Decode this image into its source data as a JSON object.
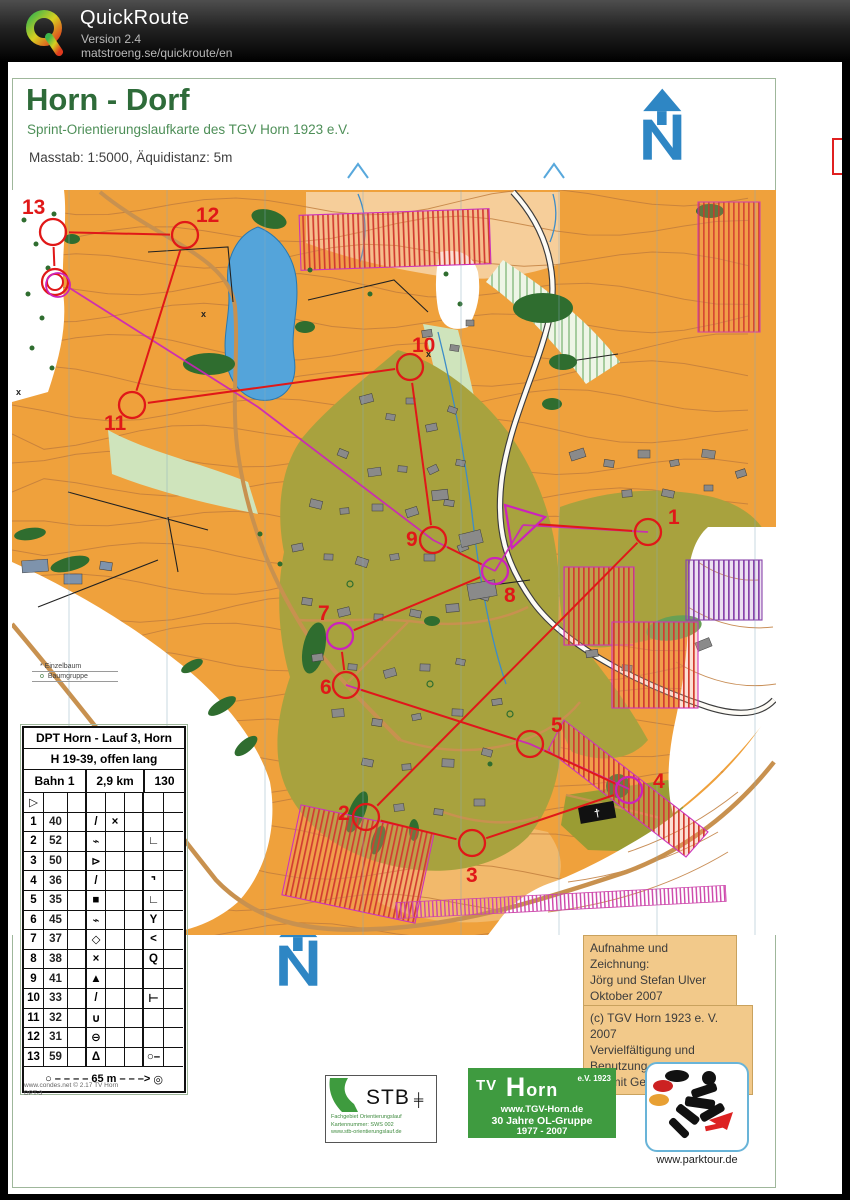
{
  "titlebar": {
    "app_name": "QuickRoute",
    "version": "Version 2.4",
    "url": "matstroeng.se/quickroute/en"
  },
  "map_header": {
    "title": "Horn - Dorf",
    "subtitle": "Sprint-Orientierungslaufkarte des TGV Horn 1923 e.V.",
    "scale_line": "Masstab: 1:5000, Äquidistanz: 5m"
  },
  "north_arrow": {
    "label": "N"
  },
  "tree_legend": {
    "items": [
      {
        "marker": "*",
        "label": "Einzelbaum"
      },
      {
        "marker": "o",
        "label": "Baumgruppe"
      }
    ]
  },
  "course": {
    "primary_color": "#e01818",
    "secondary_color": "#cc22bb",
    "controls": [
      {
        "n": "1",
        "x": 640,
        "y": 470,
        "lx": 660,
        "ly": 462,
        "ring": "red"
      },
      {
        "n": "2",
        "x": 358,
        "y": 755,
        "lx": 330,
        "ly": 758,
        "ring": "red"
      },
      {
        "n": "3",
        "x": 464,
        "y": 781,
        "lx": 458,
        "ly": 820,
        "ring": "red"
      },
      {
        "n": "4",
        "x": 621,
        "y": 728,
        "lx": 645,
        "ly": 726,
        "ring": "magenta"
      },
      {
        "n": "5",
        "x": 522,
        "y": 682,
        "lx": 543,
        "ly": 670,
        "ring": "red"
      },
      {
        "n": "6",
        "x": 338,
        "y": 623,
        "lx": 312,
        "ly": 632,
        "ring": "red"
      },
      {
        "n": "7",
        "x": 332,
        "y": 574,
        "lx": 310,
        "ly": 558,
        "ring": "magenta"
      },
      {
        "n": "8",
        "x": 487,
        "y": 509,
        "lx": 496,
        "ly": 540,
        "ring": "magenta"
      },
      {
        "n": "9",
        "x": 425,
        "y": 478,
        "lx": 398,
        "ly": 484,
        "ring": "red"
      },
      {
        "n": "10",
        "x": 402,
        "y": 305,
        "lx": 404,
        "ly": 290,
        "ring": "red"
      },
      {
        "n": "11",
        "x": 124,
        "y": 343,
        "lx": 96,
        "ly": 368,
        "ring": "red"
      },
      {
        "n": "12",
        "x": 177,
        "y": 173,
        "lx": 188,
        "ly": 160,
        "ring": "red"
      },
      {
        "n": "13",
        "x": 45,
        "y": 170,
        "lx": 14,
        "ly": 152,
        "ring": "red"
      }
    ],
    "start": {
      "points": [
        [
          497,
          443
        ],
        [
          537,
          455
        ],
        [
          504,
          486
        ]
      ],
      "cx": 513,
      "cy": 461
    },
    "finish": {
      "x": 47,
      "y": 220
    },
    "second_course_lines": [
      [
        [
          60,
          225
        ],
        [
          250,
          345
        ],
        [
          425,
          478
        ],
        [
          487,
          509
        ]
      ],
      [
        [
          487,
          509
        ],
        [
          515,
          463
        ]
      ],
      [
        [
          338,
          623
        ],
        [
          522,
          682
        ],
        [
          621,
          727
        ]
      ],
      [
        [
          515,
          463
        ],
        [
          640,
          470
        ]
      ]
    ]
  },
  "descriptions": {
    "title": "DPT Horn - Lauf 3, Horn",
    "class_line": "H 19-39, offen lang",
    "course_name": "Bahn 1",
    "course_length": "2,9 km",
    "course_climb": "130",
    "start_symbol": "▷",
    "rows": [
      {
        "no": "1",
        "code": "40",
        "sym": [
          "",
          "/",
          "×",
          "",
          "",
          ""
        ]
      },
      {
        "no": "2",
        "code": "52",
        "sym": [
          "",
          "⌁",
          "",
          "",
          "∟",
          ""
        ]
      },
      {
        "no": "3",
        "code": "50",
        "sym": [
          "",
          "⊳",
          "",
          "",
          "",
          ""
        ]
      },
      {
        "no": "4",
        "code": "36",
        "sym": [
          "",
          "/",
          "",
          "",
          "⌝",
          ""
        ]
      },
      {
        "no": "5",
        "code": "35",
        "sym": [
          "",
          "■",
          "",
          "",
          "∟",
          ""
        ]
      },
      {
        "no": "6",
        "code": "45",
        "sym": [
          "",
          "⌁",
          "",
          "",
          "Y",
          ""
        ]
      },
      {
        "no": "7",
        "code": "37",
        "sym": [
          "",
          "◇",
          "",
          "",
          "<",
          ""
        ]
      },
      {
        "no": "8",
        "code": "38",
        "sym": [
          "",
          "×",
          "",
          "",
          "Q",
          ""
        ]
      },
      {
        "no": "9",
        "code": "41",
        "sym": [
          "",
          "▲",
          "",
          "",
          "",
          ""
        ]
      },
      {
        "no": "10",
        "code": "33",
        "sym": [
          "",
          "/",
          "",
          "",
          "⊢",
          ""
        ]
      },
      {
        "no": "11",
        "code": "32",
        "sym": [
          "",
          "∪",
          "",
          "",
          "",
          ""
        ]
      },
      {
        "no": "12",
        "code": "31",
        "sym": [
          "",
          "⊖",
          "",
          "",
          "",
          ""
        ]
      },
      {
        "no": "13",
        "code": "59",
        "sym": [
          "",
          "Δ",
          "",
          "",
          "○–",
          ""
        ]
      }
    ],
    "footer": {
      "start_glyph": "○",
      "dashes_left": "– – – –",
      "distance": "65 m",
      "dashes_right": "– – –>",
      "finish_glyph": "◎"
    }
  },
  "fine_print": {
    "line1": "www.condes.net © 2.17 TV Horn",
    "line2": "DPT-3"
  },
  "credits_box": {
    "lines": [
      "Aufnahme und Zeichnung:",
      "Jörg und Stefan Ulver",
      "Oktober 2007"
    ]
  },
  "copyright_box": {
    "lines": [
      "(c) TGV Horn 1923 e. V. 2007",
      "Vervielfältigung und Benutzung",
      "nur mit Gehnemigung."
    ]
  },
  "logos": {
    "stb": {
      "name": "STB",
      "icon": "╪",
      "lines": [
        "Fachgebiet Orientierungslauf",
        "Kartennummer: SWS 002",
        "www.stb-orientierungslauf.de"
      ]
    },
    "tgv": {
      "mark": "TV",
      "main_h": "H",
      "main_rest": "orn",
      "badge": "e.V. 1923",
      "url": "www.TGV-Horn.de",
      "line2": "30 Jahre OL-Gruppe",
      "line3": "1977 - 2007"
    },
    "parktour": {
      "caption": "www.parktour.de"
    }
  },
  "colors": {
    "open_land": "#efa13c",
    "rough_open": "#f6ce9a",
    "settlement": "#a8a23e",
    "forest_green": "#2f6d2f",
    "lake": "#54a4da",
    "contour": "#c07c3c",
    "course_red": "#e01818",
    "course_magenta": "#cc22bb",
    "north_blue": "#2e86c4"
  }
}
